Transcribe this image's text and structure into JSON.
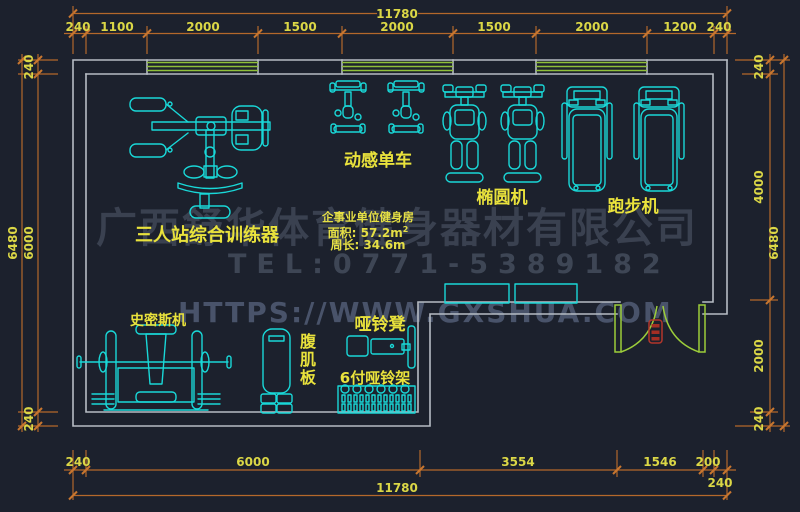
{
  "watermark": {
    "company": "广西舒华体育健身器材有限公司",
    "tel": "TEL:0771-5389182",
    "url": "HTTPS://WWW.GXSHUA.COM"
  },
  "room_info": {
    "name": "企事业单位健身房",
    "area": "面积: 57.2m",
    "area_sup": "2",
    "perimeter": "周长: 34.6m"
  },
  "equipment": {
    "trainer": "三人站综合训练器",
    "spin_bike": "动感单车",
    "elliptical": "椭圆机",
    "treadmill": "跑步机",
    "smith": "史密斯机",
    "ab_board": "腹肌板",
    "dumbbell_bench": "哑铃凳",
    "dumbbell_rack": "6付哑铃架"
  },
  "dimensions": {
    "top": {
      "total": "11780",
      "chain": [
        "240",
        "1100",
        "2000",
        "1500",
        "2000",
        "1500",
        "2000",
        "1200",
        "240"
      ]
    },
    "bottom": {
      "total": "11780",
      "chain": [
        "240",
        "6000",
        "3554",
        "1546",
        "200",
        "240"
      ]
    },
    "left": {
      "total": "6480",
      "chain": [
        "240",
        "6000",
        "240"
      ]
    },
    "right": {
      "total": "6480",
      "chain": [
        "240",
        "4000",
        "2000",
        "240"
      ]
    }
  },
  "colors": {
    "background": "#1c212d",
    "dimension_line": "#b4682b",
    "dimension_text": "#dbd746",
    "label_text": "#e9e23c",
    "wall": "#b6bcc4",
    "window": "#8fbf3a",
    "door": "#9ccd3a",
    "equipment": "#19d8d8",
    "door_symbol": "#b3362b"
  }
}
